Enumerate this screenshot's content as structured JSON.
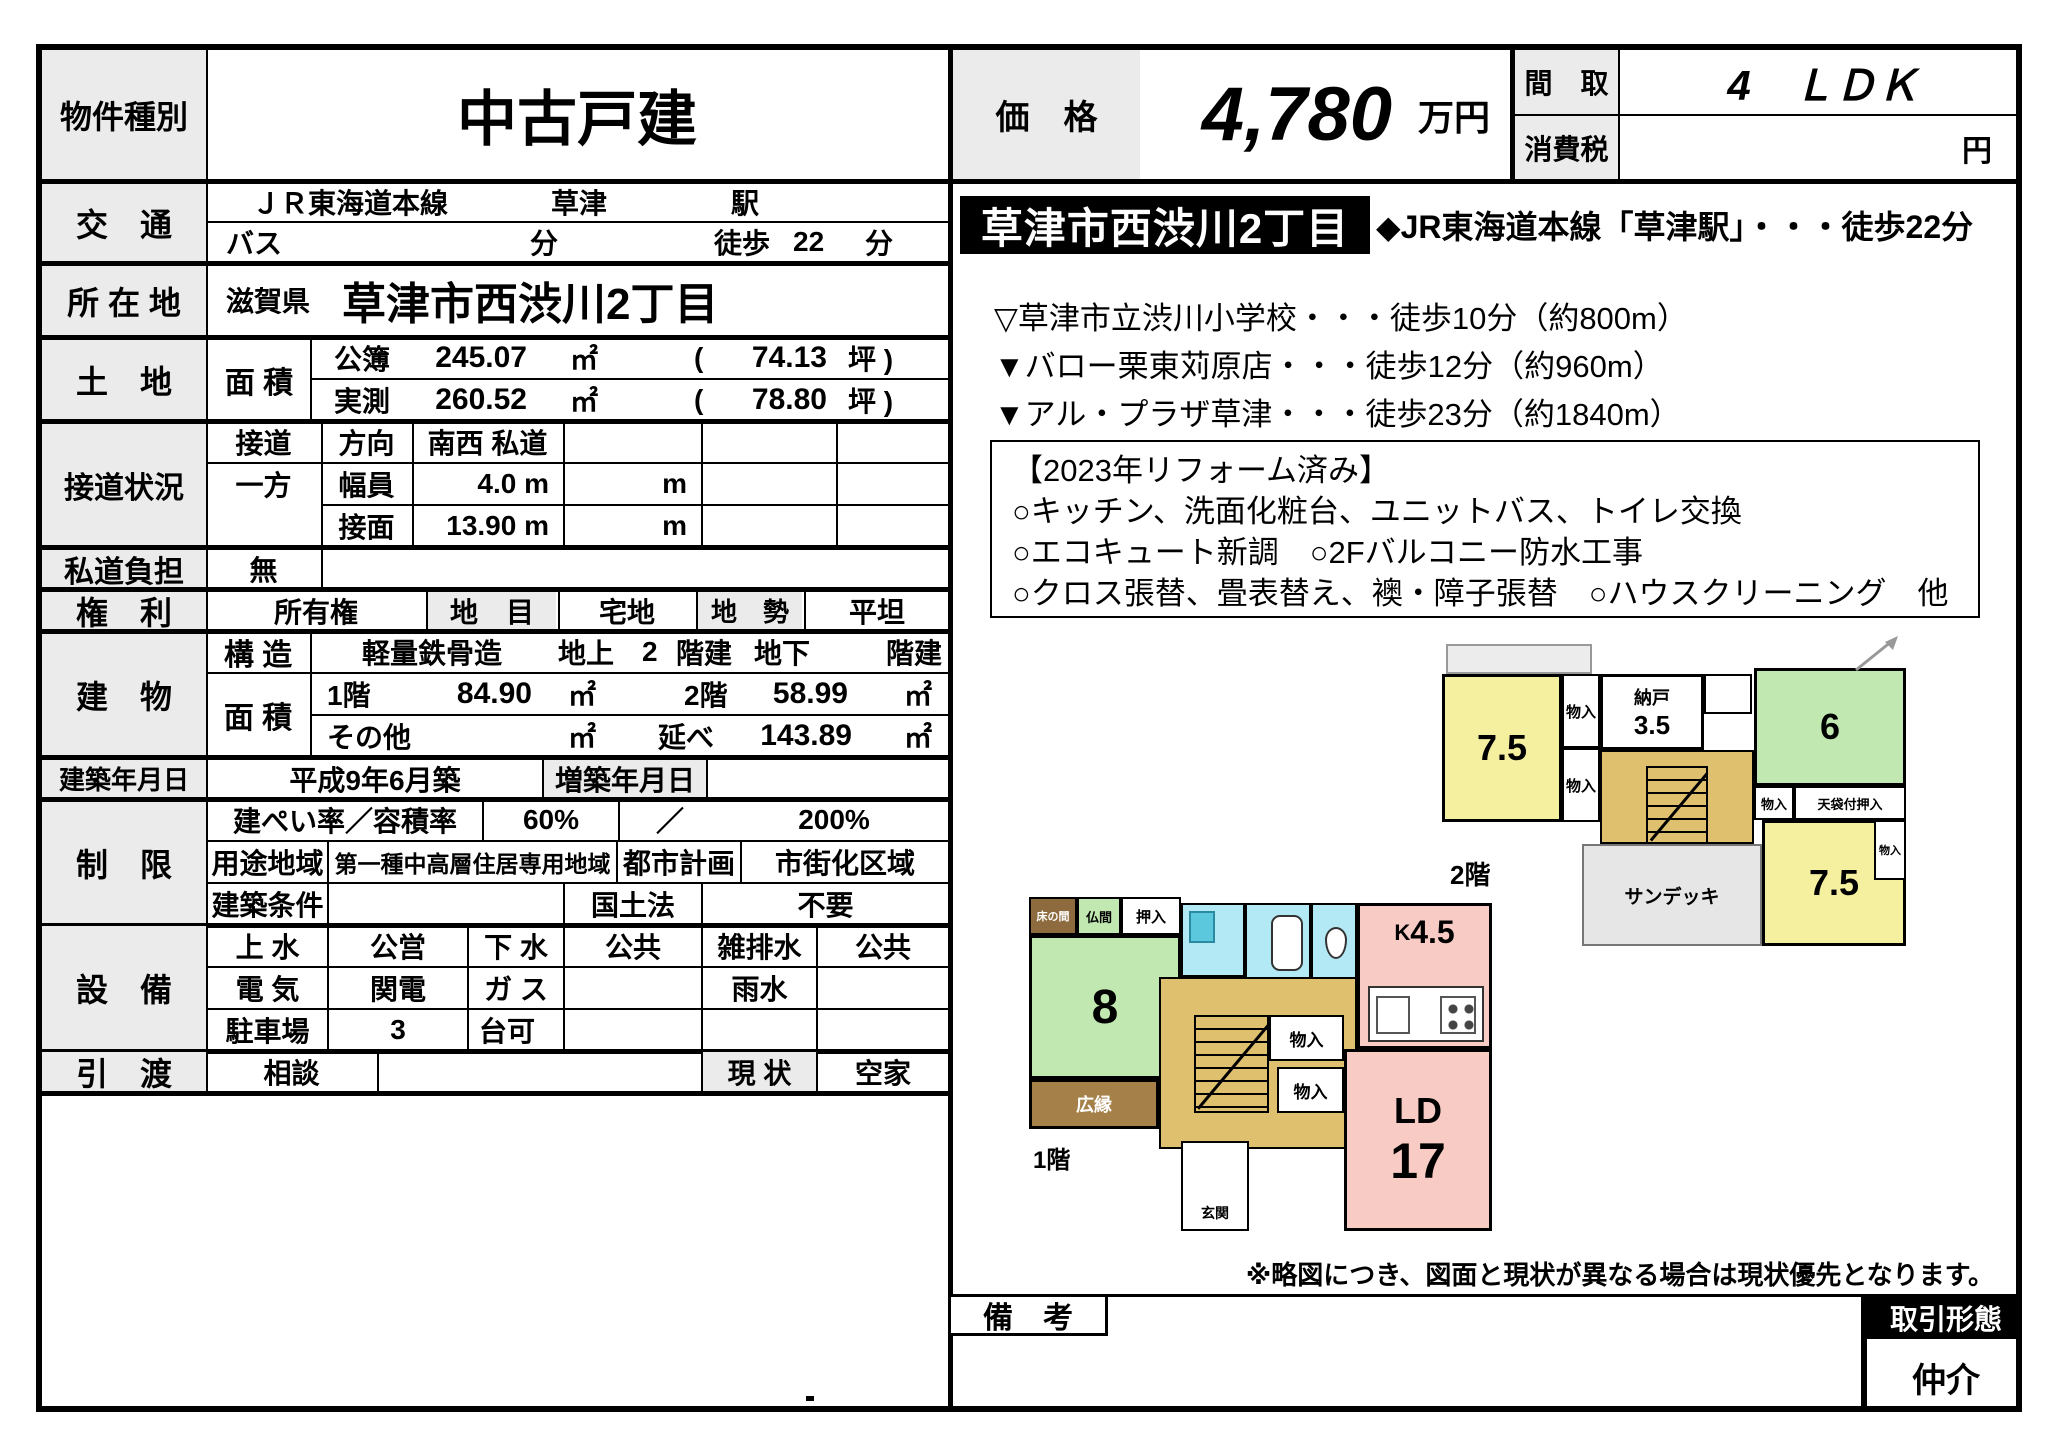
{
  "property": {
    "type_label": "物件種別",
    "type_value": "中古戸建"
  },
  "price": {
    "label": "価　格",
    "value": "4,780",
    "unit": "万円",
    "layout_label": "間　取",
    "layout_value": "4　ＬＤＫ",
    "tax_label": "消費税",
    "tax_unit": "円"
  },
  "transport": {
    "label": "交　通",
    "line": "ＪＲ東海道本線",
    "station": "草津",
    "station_suffix": "駅",
    "bus_label": "バス",
    "bus_unit": "分",
    "walk_label": "徒歩",
    "walk_min": "22",
    "walk_unit": "分"
  },
  "address": {
    "label": "所 在 地",
    "prefecture": "滋賀県",
    "value": "草津市西渋川2丁目"
  },
  "land": {
    "label": "土　地",
    "area_label": "面 積",
    "registered_label": "公簿",
    "registered_value": "245.07",
    "sqm": "㎡",
    "paren_open": "(",
    "registered_tsubo": "74.13",
    "tsubo_close": "坪 )",
    "measured_label": "実測",
    "measured_value": "260.52",
    "measured_tsubo": "78.80"
  },
  "road": {
    "label": "接道状況",
    "r1c1": "接道",
    "r1c2": "方向",
    "r1c3": "南西 私道",
    "r2c1": "一方",
    "r2c2": "幅員",
    "r2c3": "4.0 m",
    "r2c4": "m",
    "r3c2": "接面",
    "r3c3": "13.90 m",
    "r3c4": "m"
  },
  "private_road": {
    "label": "私道負担",
    "value": "無"
  },
  "rights": {
    "label": "権　利",
    "value": "所有権",
    "land_cat_label": "地　目",
    "land_cat": "宅地",
    "terrain_label": "地　勢",
    "terrain": "平坦"
  },
  "building": {
    "label": "建　物",
    "structure_label": "構 造",
    "structure": "軽量鉄骨造",
    "above_label": "地上",
    "above_floors": "2",
    "above_unit": "階建",
    "below_label": "地下",
    "below_unit": "階建",
    "area_label": "面 積",
    "f1_label": "1階",
    "f1_area": "84.90",
    "sqm": "㎡",
    "f2_label": "2階",
    "f2_area": "58.99",
    "other_label": "その他",
    "total_label": "延べ",
    "total_area": "143.89"
  },
  "built": {
    "label": "建築年月日",
    "value": "平成9年6月築",
    "extension_label": "増築年月日"
  },
  "restrictions": {
    "label": "制　限",
    "coverage_label": "建ぺい率／容積率",
    "coverage": "60%",
    "slash": "／",
    "floor_ratio": "200%",
    "zoning_label": "用途地域",
    "zoning": "第一種中高層住居専用地域",
    "city_plan_label": "都市計画",
    "city_plan": "市街化区域",
    "conditions_label": "建築条件",
    "land_law_label": "国土法",
    "land_law": "不要"
  },
  "utilities": {
    "label": "設　備",
    "water_label": "上 水",
    "water": "公営",
    "sewer_label": "下 水",
    "sewer": "公共",
    "drain_label": "雑排水",
    "drain": "公共",
    "electric_label": "電 気",
    "electric": "関電",
    "gas_label": "ガ ス",
    "rain_label": "雨水",
    "parking_label": "駐車場",
    "parking": "3",
    "parking_unit": "台可"
  },
  "handover": {
    "label": "引　渡",
    "value": "相談",
    "status_label": "現 状",
    "status": "空家"
  },
  "highlight": {
    "area_badge": "草津市西渋川2丁目",
    "station_line": "◆JR東海道本線「草津駅」・・・徒歩22分",
    "poi": [
      "▽草津市立渋川小学校・・・徒歩10分（約800m）",
      "▼バロー栗東苅原店・・・徒歩12分（約960m）",
      "▼アル・プラザ草津・・・徒歩23分（約1840m）"
    ],
    "renovation_title": "【2023年リフォーム済み】",
    "renovation_items": [
      "○キッチン、洗面化粧台、ユニットバス、トイレ交換",
      "○エコキュート新調　○2Fバルコニー防水工事",
      "○クロス張替、畳表替え、襖・障子張替　○ハウスクリーニング　他"
    ]
  },
  "plan2f": {
    "floor_label": "2階",
    "room_a": "7.5",
    "closet_a1": "物入",
    "closet_a2": "物入",
    "storage_name": "納戸",
    "storage_size": "3.5",
    "room_b": "6",
    "closet_hall": "物入",
    "tenbukuro": "天袋付押入",
    "room_c": "7.5",
    "closet_c": "物入",
    "sundeck": "サンデッキ"
  },
  "plan1f": {
    "floor_label": "1階",
    "tokonoma": "床の間",
    "butsuma": "仏間",
    "oshiire": "押入",
    "tatami_size": "8",
    "hiroen": "広縁",
    "kitchen_k": "K",
    "kitchen_size": "4.5",
    "closet1": "物入",
    "closet2": "物入",
    "ld_label": "LD",
    "ld_size": "17",
    "genkan": "玄関"
  },
  "footer": {
    "disclaimer": "※略図につき、図面と現状が異なる場合は現状優先となります。",
    "remarks_label": "備　考",
    "transaction_label": "取引形態",
    "transaction_value": "仲介"
  }
}
